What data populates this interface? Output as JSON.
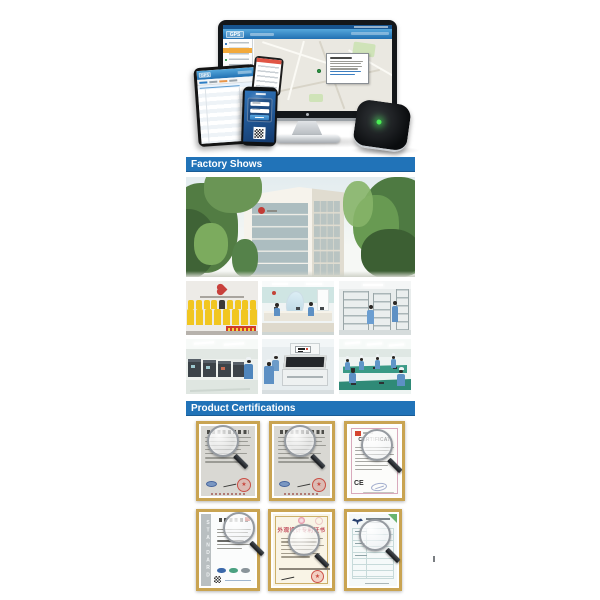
{
  "page": {
    "kind": "product-detail image section",
    "background": "#ffffff"
  },
  "colors": {
    "section_bar_blue": "#2173b8",
    "cert_frame_gold": "#c9a452",
    "tracker_led_green": "#49ef53",
    "team_shirt_yellow": "#f1c620"
  },
  "hero": {
    "app_logo": "GPS",
    "devices": [
      "desktop monitor showing gps tracking map",
      "tablet showing tracking list",
      "smartphone showing login screen with qr code",
      "smartphone showing app list",
      "gps tracker device with green led"
    ]
  },
  "sections": {
    "factory": {
      "title": "Factory Shows"
    },
    "certifications": {
      "title": "Product Certifications"
    }
  },
  "factory_photos": [
    {
      "id": "building",
      "label": "factory building exterior with trees"
    },
    {
      "id": "team",
      "label": "staff group photo in yellow shirts with company logo"
    },
    {
      "id": "office",
      "label": "production office workstations"
    },
    {
      "id": "warehouse",
      "label": "warehouse shelving racks"
    },
    {
      "id": "machines",
      "label": "production machine room"
    },
    {
      "id": "testing",
      "label": "automated testing machine"
    },
    {
      "id": "assembly",
      "label": "assembly line workers"
    }
  ],
  "certificates": {
    "row1": [
      {
        "id": "cert-registration-1",
        "label": "Chinese certificate with red seal and magnifier"
      },
      {
        "id": "cert-registration-2",
        "label": "Chinese certificate with red seal and magnifier"
      },
      {
        "id": "cert-ce",
        "label": "CE certificate",
        "title": "CERTIFICAT",
        "mark": "CE"
      }
    ],
    "row2": [
      {
        "id": "cert-iso",
        "label": "ISO standard certificate",
        "side_text": "STANDARD"
      },
      {
        "id": "cert-design-patent",
        "label": "design patent certificate",
        "title": "外观设计专利证书"
      },
      {
        "id": "cert-test-report",
        "label": "test report certificate with eagle emblem"
      }
    ]
  }
}
